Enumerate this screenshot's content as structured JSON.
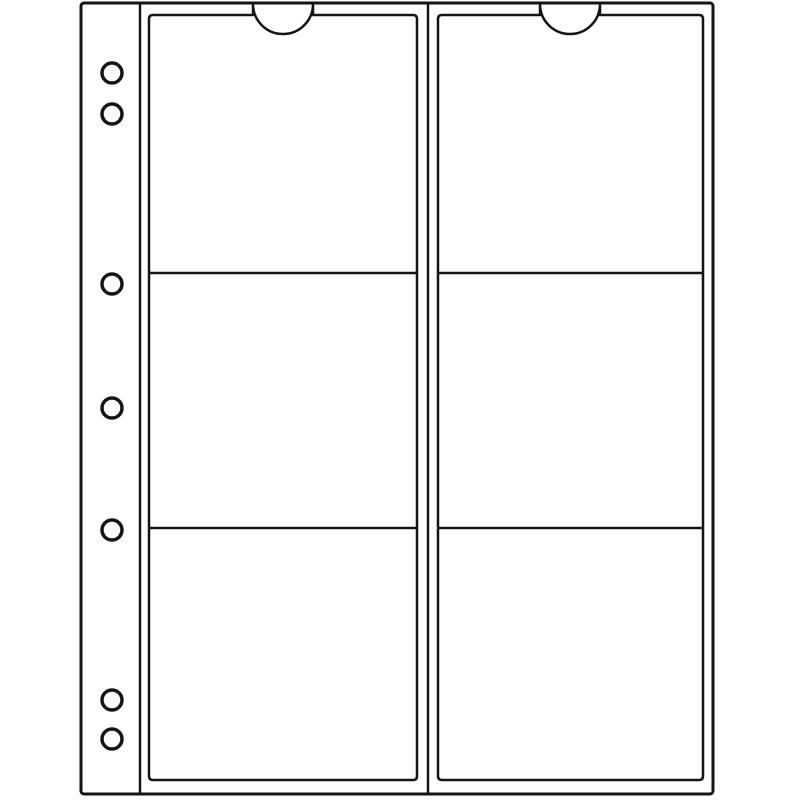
{
  "figure": {
    "description": "Line drawing of a coin album refill sheet: two pocket columns of three pockets each, with a punched binder margin",
    "colors": {
      "background": "#ffffff",
      "sheet_fill": "#ffffff",
      "line": "#141414"
    },
    "sheet": {
      "x": 81,
      "y": 3,
      "width": 632,
      "height": 791,
      "corner_radius": 3,
      "stroke_width": 3
    },
    "binder_margin": {
      "fold_line_x": 140,
      "holes_cx": 112,
      "hole_radius": 10,
      "hole_stroke_width": 3.5,
      "holes_cy": [
        73,
        114,
        284,
        408,
        530,
        700,
        739
      ],
      "hole_count": 7
    },
    "center_seam_x": 428,
    "pocket_stroke_width": 2.5,
    "pocket_corner_radius": 4,
    "pocket_count": 6,
    "pocket_columns": [
      {
        "name": "left",
        "x1": 149,
        "x2": 417,
        "top": 15,
        "bottom": 780,
        "notch_cx": 283,
        "notch_radius": 30,
        "notch_top_y": 4,
        "divider_ys": [
          273,
          528
        ]
      },
      {
        "name": "right",
        "x1": 438,
        "x2": 703,
        "top": 15,
        "bottom": 780,
        "notch_cx": 570,
        "notch_radius": 30,
        "notch_top_y": 4,
        "divider_ys": [
          273,
          528
        ]
      }
    ]
  }
}
